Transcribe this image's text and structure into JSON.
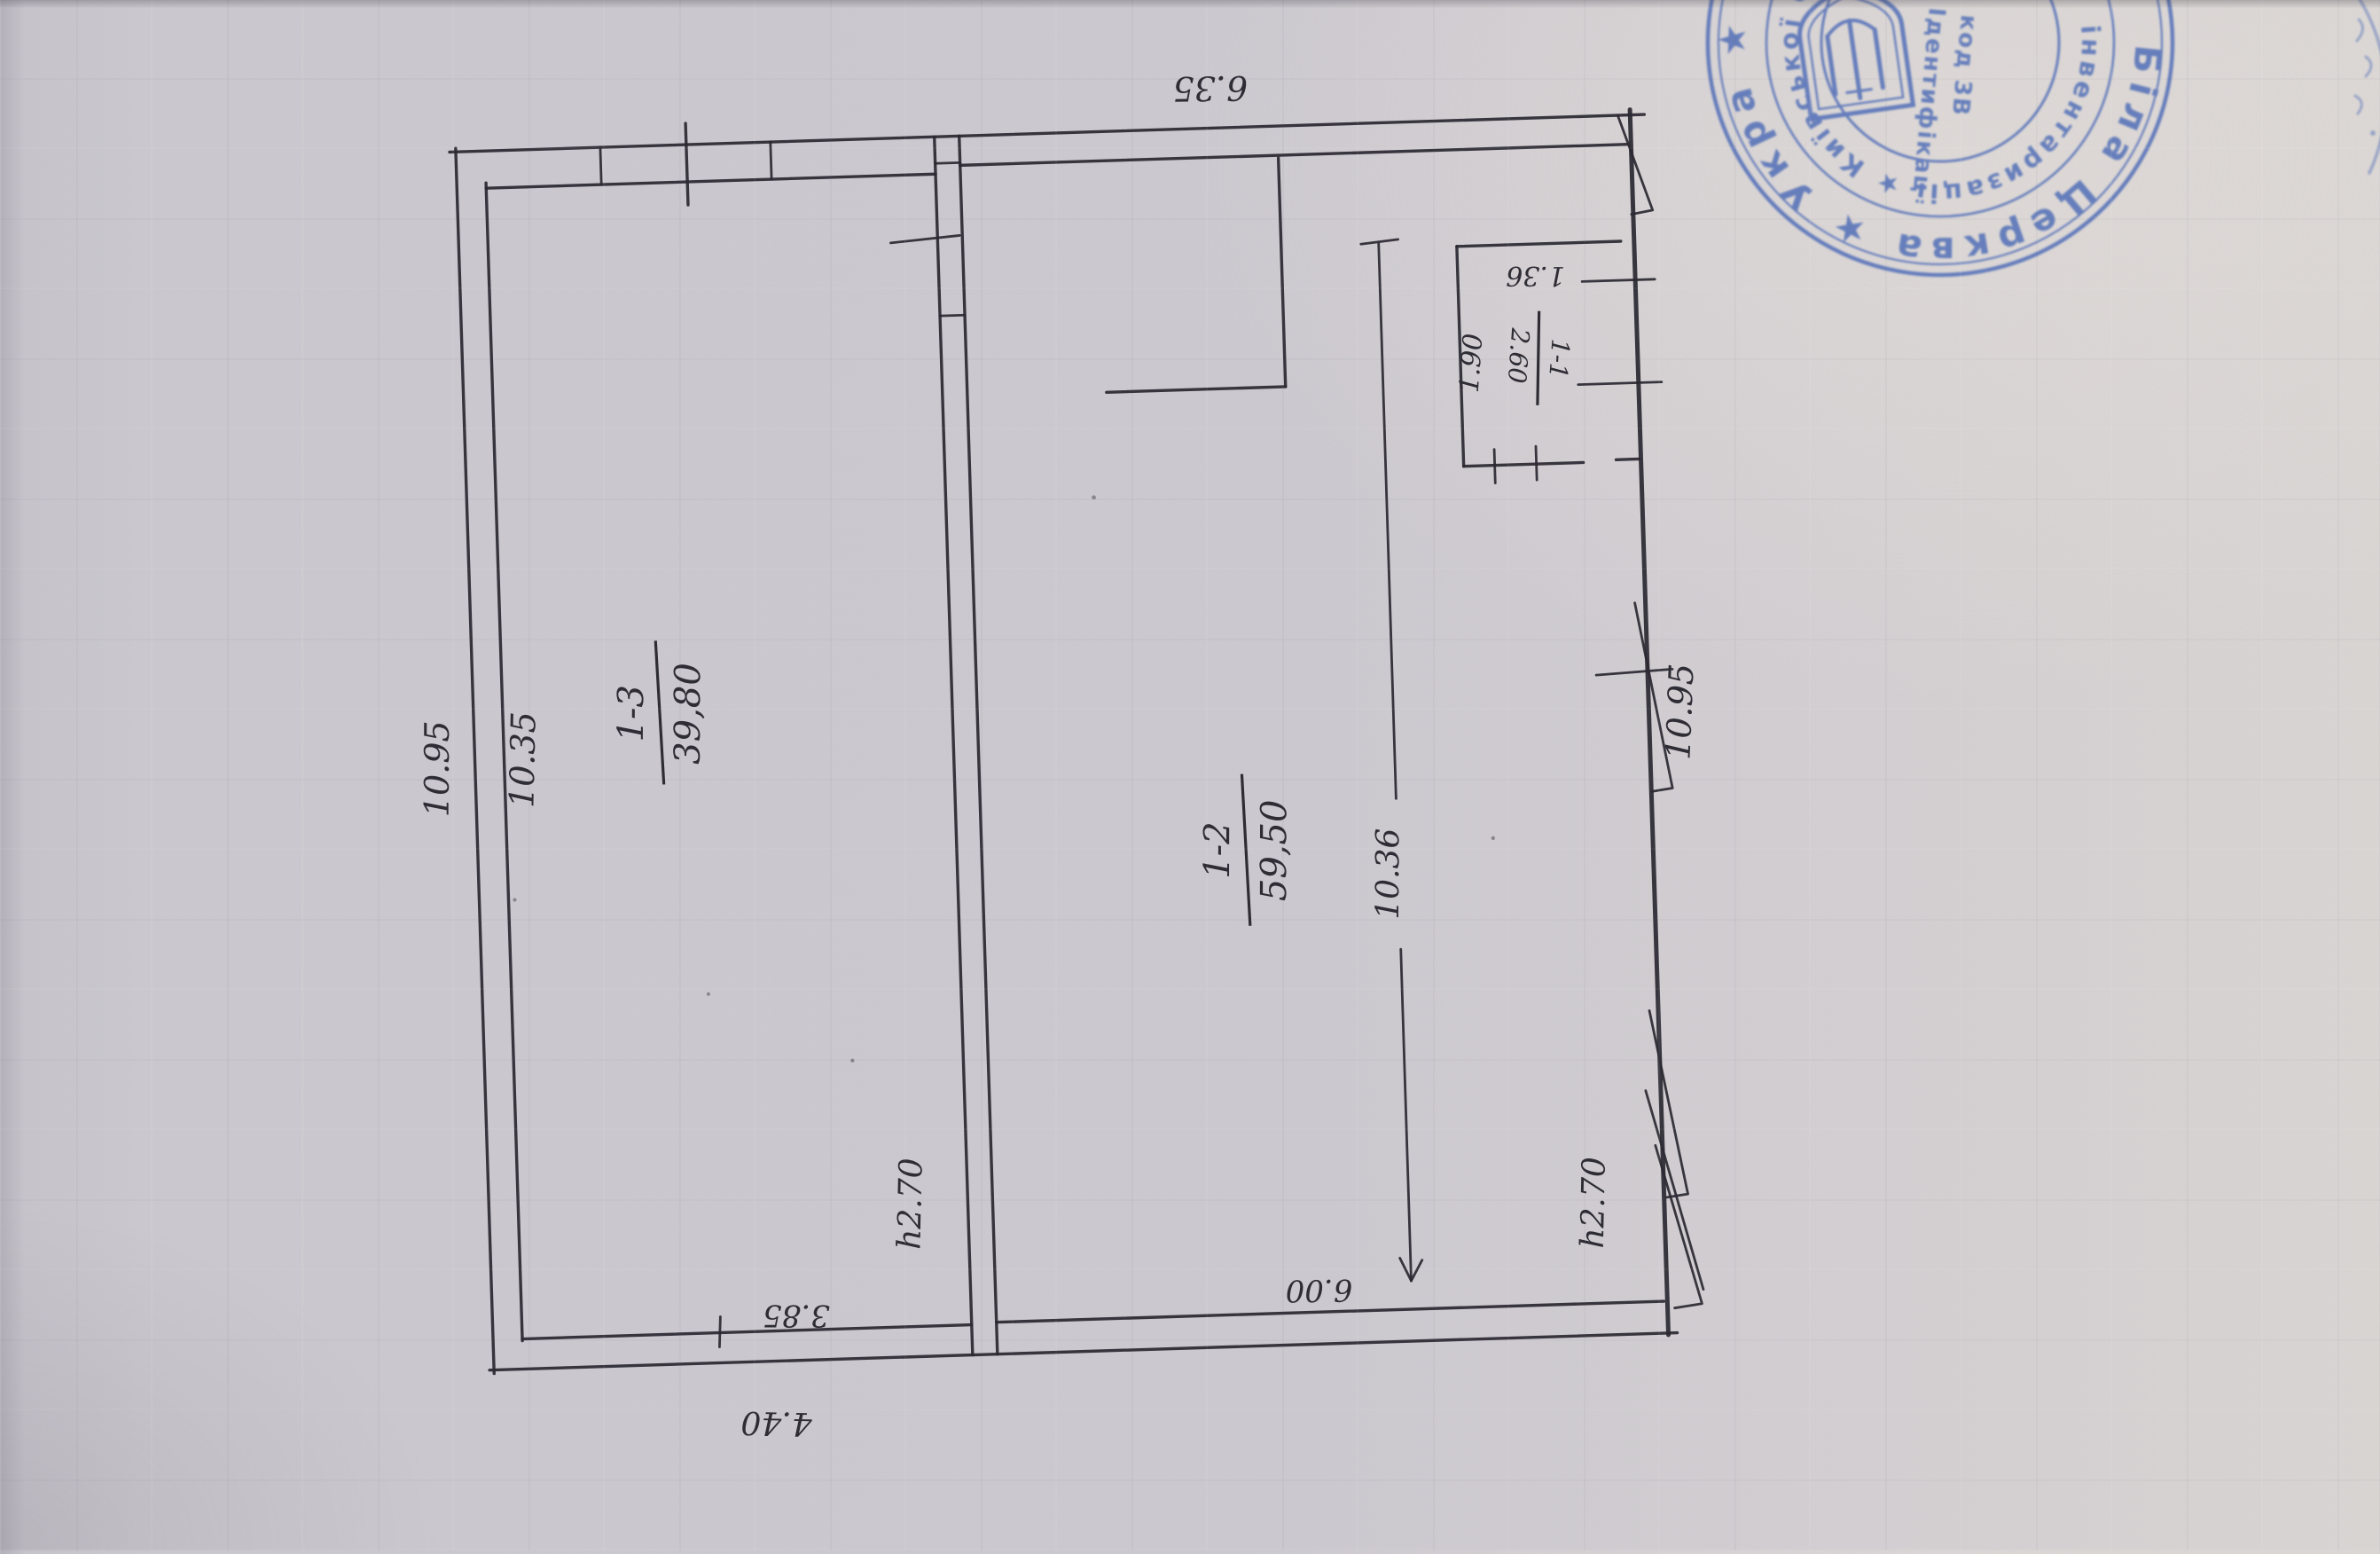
{
  "colors": {
    "paper": "#cac7ce",
    "ink": "#2b2931",
    "stamp_blue": "#4a69b5"
  },
  "rooms": [
    {
      "number": "1-3",
      "area": "39,80"
    },
    {
      "number": "1-2",
      "area": "59,50"
    },
    {
      "number": "1-1",
      "area": "2.60"
    }
  ],
  "dimensions": {
    "top_width": "6.35",
    "left_outer_height": "10.95",
    "left_inner_height": "10.35",
    "right_outer_height": "10.95",
    "room2_inner_height": "10.36",
    "room1_inner_width": "3.85",
    "bottom_outer_width": "4.40",
    "room2_inner_width": "6.00",
    "small_room_width": "1.36",
    "small_room_depth": "1.90",
    "ceiling_height_left": "h2.70",
    "ceiling_height_right": "h2.70"
  },
  "stamp": {
    "outer_ring": "Біла Церква ★ Укра ★ МІСЬК",
    "inner_ring": "інвентаризації ★ Київської обласної ради",
    "center_line1": "Ідентифікац",
    "center_line2": "код 3В"
  }
}
